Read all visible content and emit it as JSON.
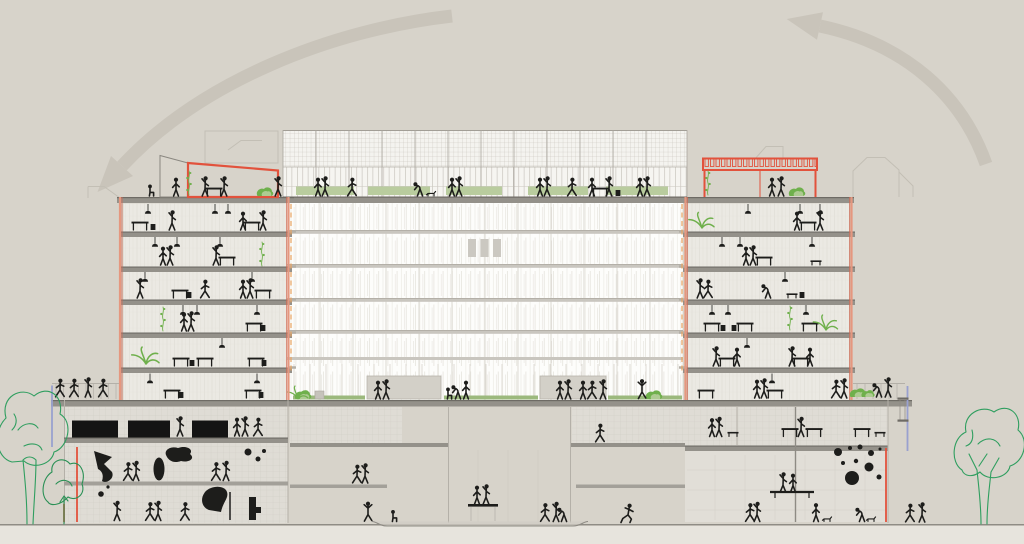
{
  "colors": {
    "bg": "#d7d3ca",
    "ground": "#e7e4dd",
    "arrow": "#c9c4ba",
    "ink": "#1d1d1b",
    "line": "#b4b0a8",
    "line_faint": "#c3bfb5",
    "slab": "#94918a",
    "slab_dark": "#6e6b65",
    "slab_light": "#c9c6bf",
    "salmon": "#e5977f",
    "red": "#e2523c",
    "orange": "#e8a35f",
    "green_bright": "#6fb04c",
    "green_light": "#aecb92",
    "green_sketch": "#2f9e5f",
    "blue": "#99a1cf",
    "box": "#d3d0c8"
  },
  "scene": {
    "kind": "architectural cross-section drawing, no legible text in image",
    "labels": {
      "left_arrow": "large faded curved arrow sweeping down to the lower left",
      "right_arrow": "large faded curved arrow sweeping up toward the left",
      "central_block": "central glazed volume with rooftop mesh screen and planted roof terrace",
      "left_tower": "left sectioned tower with six furnished floors, red section-cut edges",
      "right_tower": "right sectioned tower with six furnished floors, red section-cut edges",
      "left_roof_windscreen": "red-framed windscreen panels on left tower roof terrace",
      "right_roof_pergola": "red-framed pergola with hatched top on right tower roof",
      "podium_terrace": "landscaped podium terrace with kiosk boxes, shrubs and people",
      "left_wing": "left podium wing with railing and roof walkway",
      "right_wing": "right podium wing with shrubs and blue scaffold edge",
      "basement_left": "left basement gallery: black exhibit screens, abstract sculptures, dots",
      "basement_center": "central sunken hall with mezzanines, pedestal and recessed floor",
      "basement_right": "right double-height hall with dotted climbing wall and platform",
      "trees_left": "two sketched green trees at far left",
      "tree_right": "sketched green tree at far right",
      "ground": "ground line with lighter footing strip"
    }
  }
}
